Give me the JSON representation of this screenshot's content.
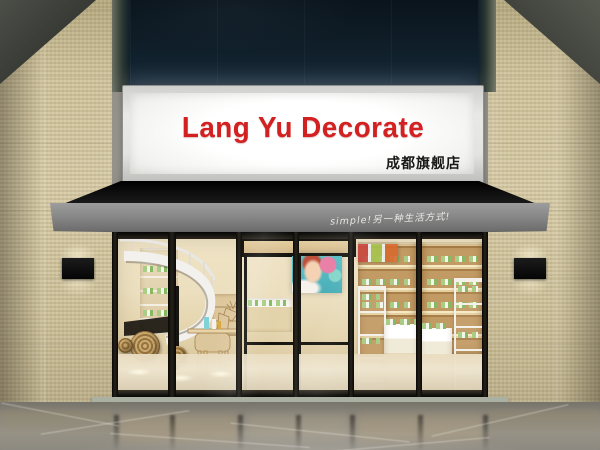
{
  "scene": {
    "type": "storefront-render",
    "sign": {
      "title": "Lang Yu Decorate",
      "subtitle": "成都旗舰店",
      "title_color": "#d32020",
      "subtitle_color": "#181818",
      "panel_color": "#f6f6f4"
    },
    "awning": {
      "slogan": "simple!另一种生活方式!",
      "slogan_color": "#f1f1ee",
      "canopy_color": "#0d0d0d",
      "valance_color": "#868686"
    },
    "facade": {
      "upper_panel_color": "#101f2a",
      "tile_color": "#cfc39d",
      "wall_lamp_color": "#0a0a0a"
    },
    "storefront": {
      "frame_color": "#14120d",
      "interior_wall_color": "#ecdfbf",
      "wood_color": "#c29a63",
      "shelf_white": "#f3f1ea",
      "product_green": "#a9cd84",
      "poster_teal": "#49b8c4",
      "elements": [
        "spiral-staircase",
        "wooden-deer-sculpture",
        "woven-disc-decor",
        "glass-double-door",
        "beauty-poster",
        "display-tables",
        "white-ladder-shelves",
        "backlit-wood-shelving"
      ]
    },
    "floor": {
      "marble_color": "#8a867d",
      "threshold_color": "#8d9487"
    }
  }
}
